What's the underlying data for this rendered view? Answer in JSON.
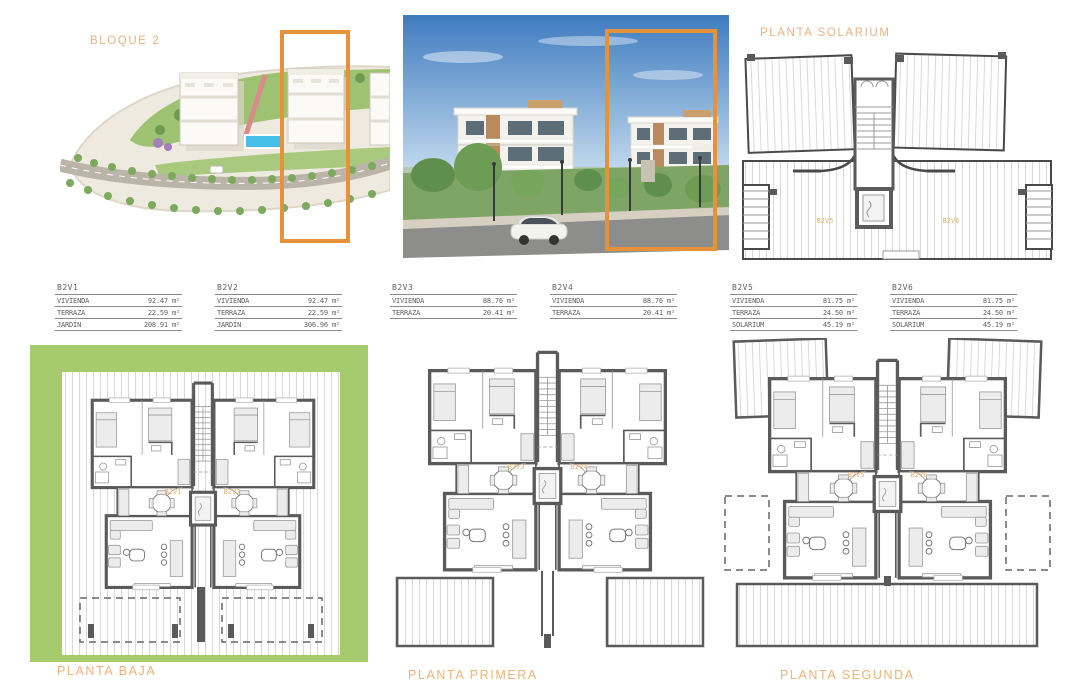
{
  "document": {
    "bloque_title": "BLOQUE 2",
    "solarium_title": "PLANTA SOLARIUM"
  },
  "colors": {
    "accent_orange": "#E8913B",
    "label_tan": "#EBB283",
    "garden_green": "#A6CB6F",
    "wall_gray": "#5A5A5A",
    "pool_blue": "#45BEE8",
    "sky_blue": "#3F7CC0"
  },
  "tables": [
    {
      "unit": "B2V1",
      "rows": [
        {
          "label": "VIVIENDA",
          "value": "92.47 m²"
        },
        {
          "label": "TERRAZA",
          "value": "22.59 m²"
        },
        {
          "label": "JARDÍN",
          "value": "208.91 m²"
        }
      ]
    },
    {
      "unit": "B2V2",
      "rows": [
        {
          "label": "VIVIENDA",
          "value": "92.47 m²"
        },
        {
          "label": "TERRAZA",
          "value": "22.59 m²"
        },
        {
          "label": "JARDÍN",
          "value": "306.96 m²"
        }
      ]
    },
    {
      "unit": "B2V3",
      "rows": [
        {
          "label": "VIVIENDA",
          "value": "88.76 m²"
        },
        {
          "label": "TERRAZA",
          "value": "20.41 m²"
        }
      ]
    },
    {
      "unit": "B2V4",
      "rows": [
        {
          "label": "VIVIENDA",
          "value": "88.76 m²"
        },
        {
          "label": "TERRAZA",
          "value": "20.41 m²"
        }
      ]
    },
    {
      "unit": "B2V5",
      "rows": [
        {
          "label": "VIVIENDA",
          "value": "81.75 m²"
        },
        {
          "label": "TERRAZA",
          "value": "24.50 m²"
        },
        {
          "label": "SOLARIUM",
          "value": "45.19 m²"
        }
      ]
    },
    {
      "unit": "B2V6",
      "rows": [
        {
          "label": "VIVIENDA",
          "value": "81.75 m²"
        },
        {
          "label": "TERRAZA",
          "value": "24.50 m²"
        },
        {
          "label": "SOLARIUM",
          "value": "45.19 m²"
        }
      ]
    }
  ],
  "floor_plans": [
    {
      "label": "PLANTA BAJA",
      "unit_left": "B2V1",
      "unit_right": "B2V2"
    },
    {
      "label": "PLANTA PRIMERA",
      "unit_left": "B2V3",
      "unit_right": "B2V4"
    },
    {
      "label": "PLANTA SEGUNDA",
      "unit_left": "B2V5",
      "unit_right": "B2V6"
    }
  ],
  "solarium_plan": {
    "unit_left": "B2V5",
    "unit_right": "B2V6"
  }
}
